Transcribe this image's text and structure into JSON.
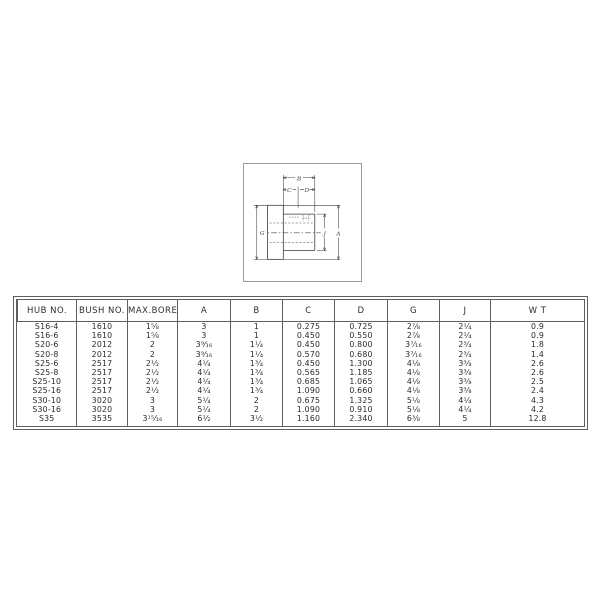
{
  "diagram": {
    "labels": {
      "b": "B",
      "c": "C",
      "d": "D",
      "g": "G",
      "j": "J",
      "a": "A"
    }
  },
  "table": {
    "headers": [
      "HUB NO.",
      "BUSH NO.",
      "MAX.BORE",
      "A",
      "B",
      "C",
      "D",
      "G",
      "J",
      "W T"
    ],
    "rows": [
      {
        "hub": "S16-4",
        "bush": "1610",
        "bore": "1⁵⁄₈",
        "a": "3",
        "b": "1",
        "c": "0.275",
        "d": "0.725",
        "g": "2⁷⁄₈",
        "j": "2¹⁄₄",
        "wt": "0.9"
      },
      {
        "hub": "S16-6",
        "bush": "1610",
        "bore": "1⁵⁄₈",
        "a": "3",
        "b": "1",
        "c": "0.450",
        "d": "0.550",
        "g": "2⁷⁄₈",
        "j": "2¹⁄₄",
        "wt": "0.9"
      },
      {
        "hub": "S20-6",
        "bush": "2012",
        "bore": "2",
        "a": "3⁹⁄₁₆",
        "b": "1¹⁄₄",
        "c": "0.450",
        "d": "0.800",
        "g": "3⁷⁄₁₆",
        "j": "2³⁄₄",
        "wt": "1.8"
      },
      {
        "hub": "S20-8",
        "bush": "2012",
        "bore": "2",
        "a": "3⁹⁄₁₆",
        "b": "1¹⁄₄",
        "c": "0.570",
        "d": "0.680",
        "g": "3⁷⁄₁₆",
        "j": "2³⁄₄",
        "wt": "1.4"
      },
      {
        "hub": "S25-6",
        "bush": "2517",
        "bore": "2¹⁄₂",
        "a": "4¹⁄₄",
        "b": "1³⁄₄",
        "c": "0.450",
        "d": "1.300",
        "g": "4¹⁄₈",
        "j": "3³⁄₈",
        "wt": "2.6"
      },
      {
        "hub": "S25-8",
        "bush": "2517",
        "bore": "2¹⁄₂",
        "a": "4¹⁄₄",
        "b": "1³⁄₄",
        "c": "0.565",
        "d": "1.185",
        "g": "4¹⁄₈",
        "j": "3³⁄₈",
        "wt": "2.6"
      },
      {
        "hub": "S25-10",
        "bush": "2517",
        "bore": "2¹⁄₂",
        "a": "4¹⁄₄",
        "b": "1³⁄₄",
        "c": "0.685",
        "d": "1.065",
        "g": "4¹⁄₈",
        "j": "3³⁄₈",
        "wt": "2.5"
      },
      {
        "hub": "S25-16",
        "bush": "2517",
        "bore": "2¹⁄₂",
        "a": "4¹⁄₄",
        "b": "1³⁄₄",
        "c": "1.090",
        "d": "0.660",
        "g": "4¹⁄₈",
        "j": "3³⁄₈",
        "wt": "2.4"
      },
      {
        "hub": "S30-10",
        "bush": "3020",
        "bore": "3",
        "a": "5¹⁄₄",
        "b": "2",
        "c": "0.675",
        "d": "1.325",
        "g": "5¹⁄₈",
        "j": "4¹⁄₄",
        "wt": "4.3"
      },
      {
        "hub": "S30-16",
        "bush": "3020",
        "bore": "3",
        "a": "5¹⁄₄",
        "b": "2",
        "c": "1.090",
        "d": "0.910",
        "g": "5¹⁄₈",
        "j": "4¹⁄₄",
        "wt": "4.2"
      },
      {
        "hub": "S35",
        "bush": "3535",
        "bore": "3¹⁵⁄₁₆",
        "a": "6¹⁄₂",
        "b": "3¹⁄₂",
        "c": "1.160",
        "d": "2.340",
        "g": "6³⁄₈",
        "j": "5",
        "wt": "12.8"
      }
    ]
  }
}
